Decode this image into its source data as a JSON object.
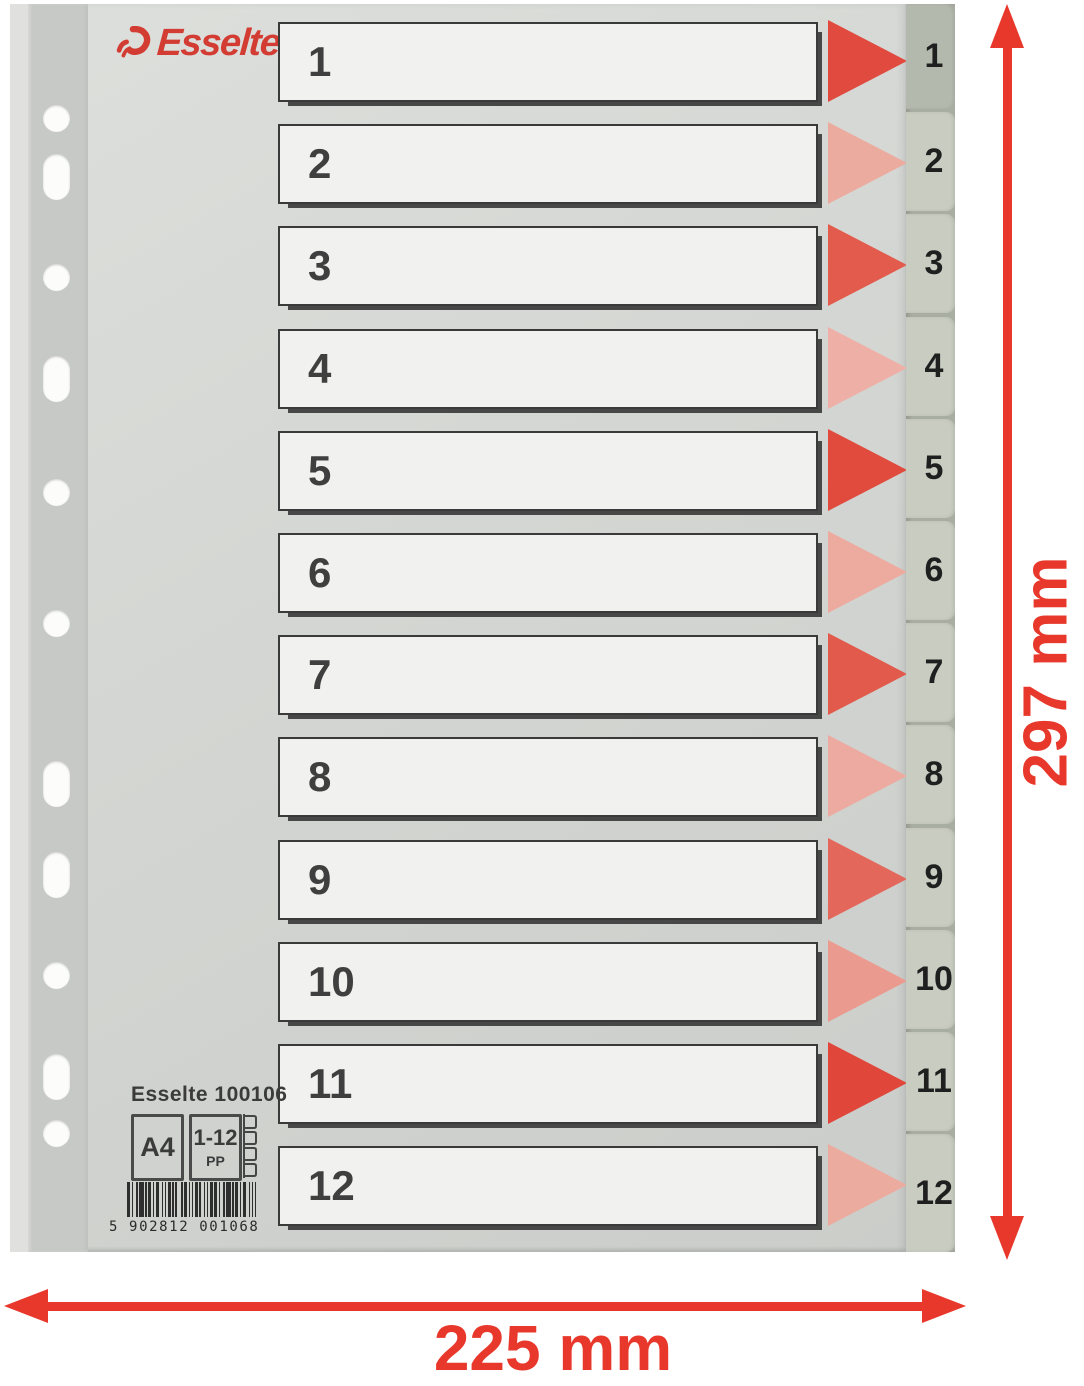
{
  "product": {
    "brand": "Esselte",
    "index_rows": [
      {
        "label": "1",
        "arrow_color": "#e04a3f"
      },
      {
        "label": "2",
        "arrow_color": "#ecab9f"
      },
      {
        "label": "3",
        "arrow_color": "#e25b4c"
      },
      {
        "label": "4",
        "arrow_color": "#eeb0a6"
      },
      {
        "label": "5",
        "arrow_color": "#e14b3e"
      },
      {
        "label": "6",
        "arrow_color": "#edab9f"
      },
      {
        "label": "7",
        "arrow_color": "#e15a4b"
      },
      {
        "label": "8",
        "arrow_color": "#ecaaa0"
      },
      {
        "label": "9",
        "arrow_color": "#e4675c"
      },
      {
        "label": "10",
        "arrow_color": "#ea9a8e"
      },
      {
        "label": "11",
        "arrow_color": "#e0463a"
      },
      {
        "label": "12",
        "arrow_color": "#ecab9f"
      }
    ],
    "info_label": {
      "product_code": "Esselte 100106",
      "format": "A4",
      "tab_range": "1-12",
      "material": "PP",
      "barcode_digits": "5 902812 001068"
    },
    "punch_holes": [
      {
        "shape": "round",
        "y": 118
      },
      {
        "shape": "oblong",
        "y": 177
      },
      {
        "shape": "round",
        "y": 277
      },
      {
        "shape": "oblong",
        "y": 379
      },
      {
        "shape": "round",
        "y": 492
      },
      {
        "shape": "round",
        "y": 623
      },
      {
        "shape": "oblong",
        "y": 784
      },
      {
        "shape": "oblong",
        "y": 875
      },
      {
        "shape": "round",
        "y": 975
      },
      {
        "shape": "oblong",
        "y": 1077
      },
      {
        "shape": "round",
        "y": 1133
      }
    ]
  },
  "annotations": {
    "height_label": "297 mm",
    "width_label": "225 mm",
    "annotation_color": "#e8382b"
  },
  "colors": {
    "sheet_grey": "#d4d6d3",
    "punch_strip_grey": "#c7c9c6",
    "label_box_fill": "#f1f1ef",
    "label_box_border": "#3a3a3a",
    "tab_fill": "#c8ccc1",
    "tab_front_fill": "#b4b9ae",
    "logo_red": "#d23c32",
    "annotation_red": "#e8382b",
    "barcode_bar": "#2e2e2e"
  }
}
